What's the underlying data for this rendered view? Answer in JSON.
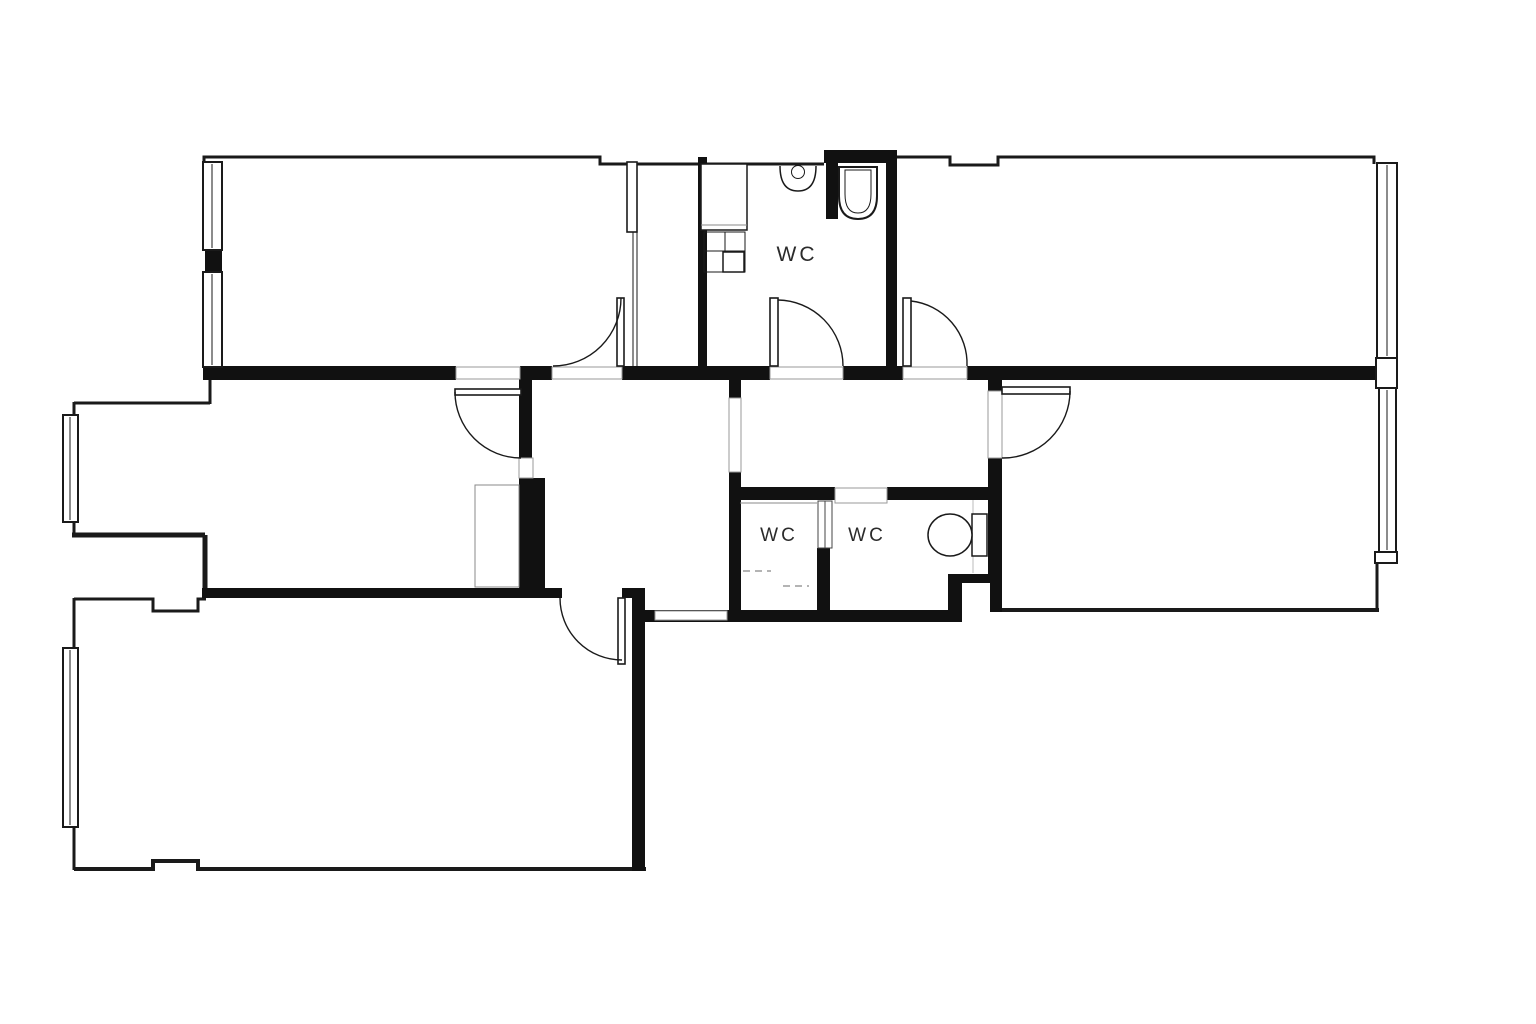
{
  "title": "Apartment floor plan",
  "labels": {
    "wc_top": "WC",
    "wc_left": "WC",
    "wc_right": "WC"
  },
  "colors": {
    "wall": "#111111",
    "background": "#ffffff",
    "outline": "#1a1a1a",
    "threshold": "#9a9a9a",
    "fixture_line": "#888888",
    "text": "#2b2b2b"
  },
  "fixtures": [
    "sink-icon",
    "toilet-icon",
    "cistern-icon",
    "washer-icon",
    "cabinet-icon",
    "counter-icon"
  ]
}
